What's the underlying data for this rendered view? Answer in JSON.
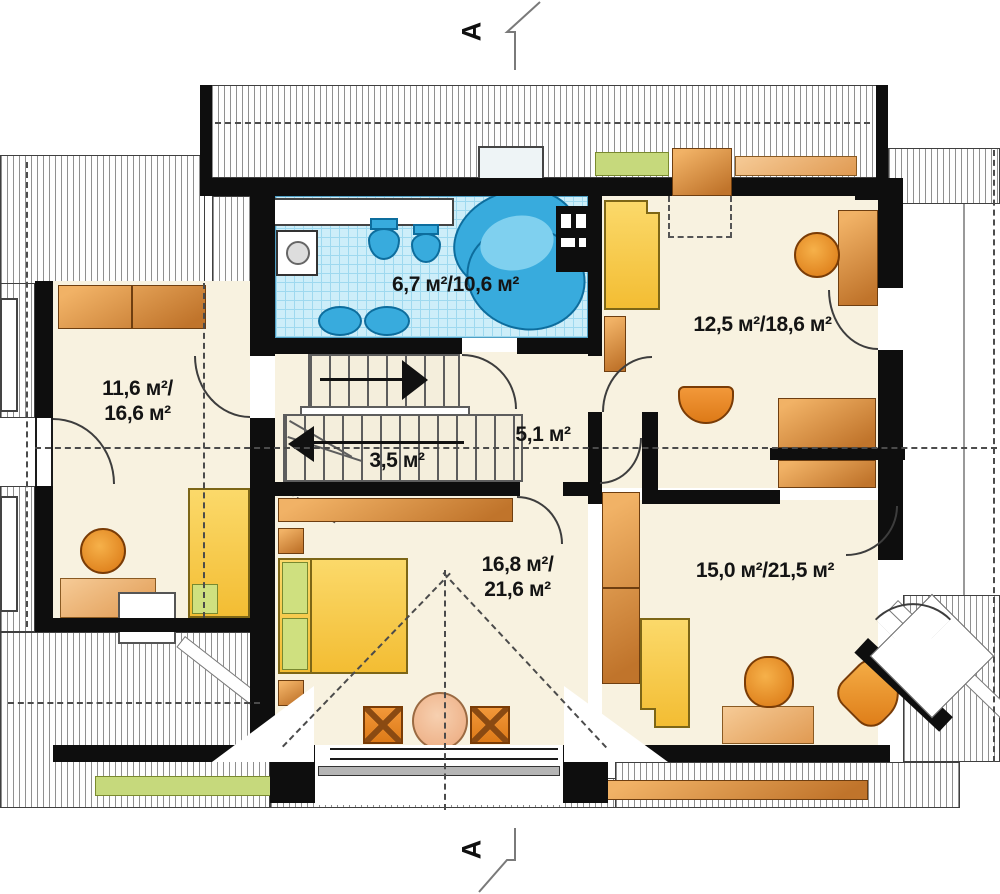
{
  "section": {
    "marker": "A"
  },
  "rooms": {
    "bathroom": {
      "area_label": "6,7 м²/10,6 м²"
    },
    "bedroom_top_right": {
      "area_label": "12,5 м²/18,6 м²"
    },
    "bedroom_left": {
      "area_label_line1": "11,6 м²/",
      "area_label_line2": "16,6 м²"
    },
    "hall": {
      "area_label": "5,1 м²"
    },
    "staircase": {
      "area_label": "3,5 м²"
    },
    "bedroom_bottom": {
      "area_label_line1": "16,8 м²/",
      "area_label_line2": "21,6 м²"
    },
    "room_bottom_right": {
      "area_label": "15,0 м²/21,5 м²"
    }
  },
  "colors": {
    "wall": "#0e0e0e",
    "floor": "#f8f2e0",
    "bath_tile": "#cdeef9",
    "fixture_blue": "#38abdd",
    "furniture_wood": "#d98b3d",
    "bed_yellow": "#f7c94d",
    "pillow_green": "#cfe07f",
    "chair_orange": "#e8862a",
    "hatch_line": "#8f8f8f"
  }
}
